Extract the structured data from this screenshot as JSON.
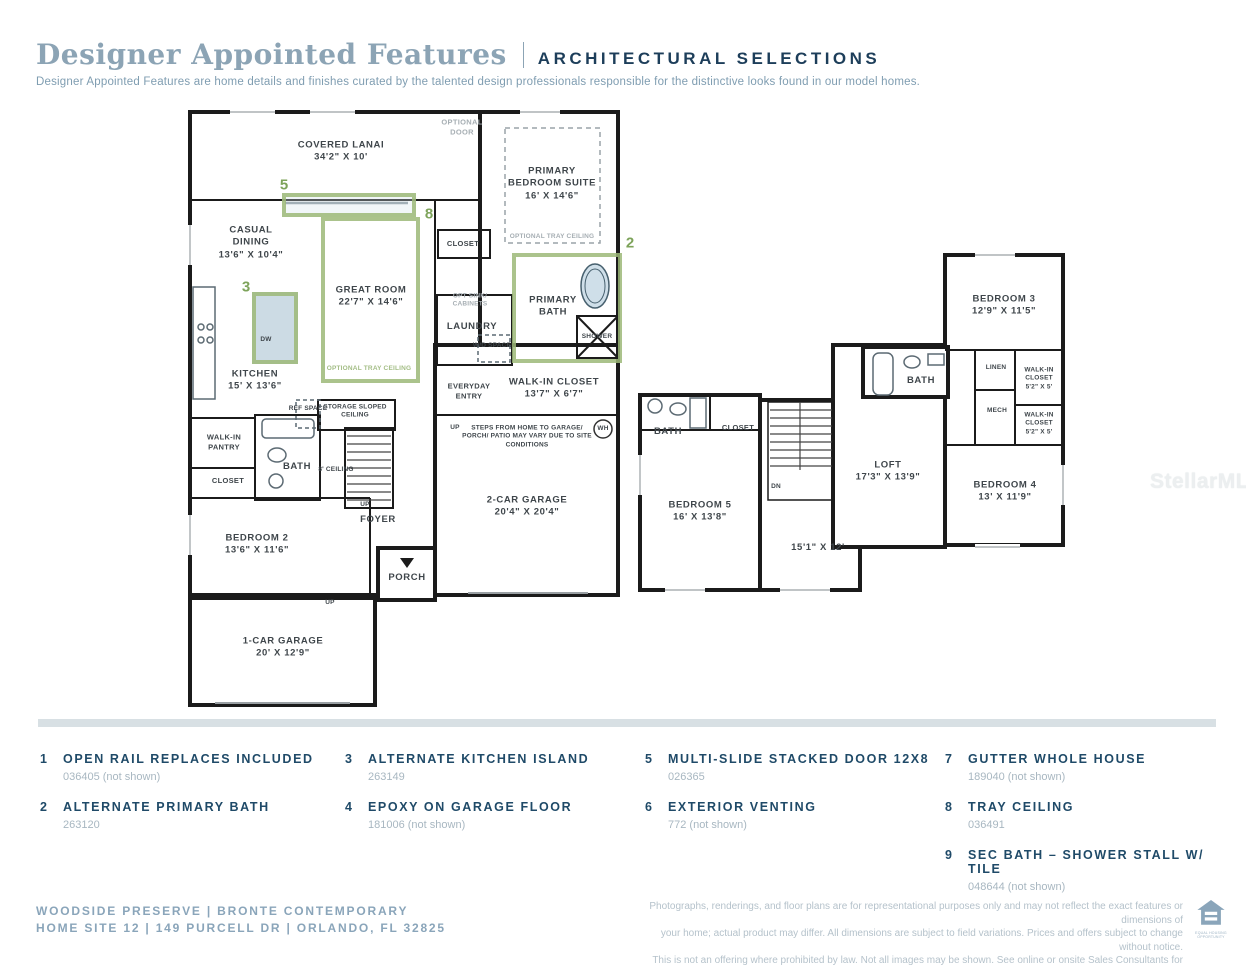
{
  "header": {
    "title": "Designer Appointed Features",
    "tag": "ARCHITECTURAL SELECTIONS",
    "subtitle": "Designer Appointed Features are home details and finishes curated by the talented design professionals responsible for the distinctive looks found in our model homes."
  },
  "watermark": "StellarMLS",
  "floor1": {
    "rooms": {
      "lanai": {
        "name": "COVERED LANAI",
        "dims": "34'2\" X 10'"
      },
      "suite": {
        "name": "PRIMARY BEDROOM SUITE",
        "dims": "16' X 14'6\""
      },
      "casual": {
        "name": "CASUAL DINING",
        "dims": "13'6\" X 10'4\""
      },
      "great": {
        "name": "GREAT ROOM",
        "dims": "22'7\" X 14'6\""
      },
      "kitchen": {
        "name": "KITCHEN",
        "dims": "15' X 13'6\""
      },
      "laundry": {
        "name": "LAUNDRY"
      },
      "pbath": {
        "name": "PRIMARY BATH"
      },
      "wic": {
        "name": "WALK-IN CLOSET",
        "dims": "13'7\" X 6'7\""
      },
      "garage2": {
        "name": "2-CAR GARAGE",
        "dims": "20'4\" X 20'4\""
      },
      "bed2": {
        "name": "BEDROOM 2",
        "dims": "13'6\" X 11'6\""
      },
      "foyer": {
        "name": "FOYER"
      },
      "porch": {
        "name": "PORCH"
      },
      "garage1": {
        "name": "1-CAR GARAGE",
        "dims": "20' X 12'9\""
      },
      "pantry": {
        "name": "WALK-IN PANTRY"
      },
      "bath": {
        "name": "BATH"
      },
      "closet_l": {
        "name": "CLOSET"
      },
      "closet_t": {
        "name": "CLOSET"
      },
      "storage": {
        "name": "STORAGE SLOPED CEILING"
      },
      "entry": {
        "name": "EVERYDAY ENTRY"
      }
    },
    "labels": {
      "optional_door": "OPTIONAL DOOR",
      "tray": "OPTIONAL TRAY CEILING",
      "opt_sink": "OPT SINK/ CABINETS",
      "wd": "W/D SPACE",
      "ref": "REF SPACE",
      "ceil8": "8' CEILING",
      "steps": "STEPS FROM HOME TO GARAGE/ PORCH/ PATIO MAY VARY DUE TO SITE CONDITIONS",
      "wh": "WH",
      "dw": "DW",
      "up": "UP",
      "shower": "SHOWER"
    },
    "annotations": {
      "door5": "5",
      "tray8": "8",
      "island3": "3",
      "bath2": "2"
    }
  },
  "floor2": {
    "rooms": {
      "bed3": {
        "name": "BEDROOM 3",
        "dims": "12'9\" X 11'5\""
      },
      "bath_r": {
        "name": "BATH"
      },
      "linen": {
        "name": "LINEN"
      },
      "wic1": {
        "name": "WALK-IN CLOSET",
        "dims": "5'2\" X 5'"
      },
      "mech": {
        "name": "MECH"
      },
      "wic2": {
        "name": "WALK-IN CLOSET",
        "dims": "5'2\" X 5'"
      },
      "bed4": {
        "name": "BEDROOM 4",
        "dims": "13' X 11'9\""
      },
      "loft": {
        "name": "LOFT",
        "dims": "17'3\" X 13'9\""
      },
      "bed5": {
        "name": "BEDROOM 5",
        "dims": "16' X 13'8\""
      },
      "bath_l": {
        "name": "BATH"
      },
      "closet": {
        "name": "CLOSET"
      },
      "open_dims": {
        "dims": "15'1\" X 12'"
      }
    },
    "labels": {
      "dn": "DN"
    }
  },
  "features": {
    "items": [
      {
        "num": "1",
        "title": "OPEN RAIL REPLACES INCLUDED",
        "code": "036405 (not shown)"
      },
      {
        "num": "2",
        "title": "ALTERNATE PRIMARY BATH",
        "code": "263120"
      },
      {
        "num": "3",
        "title": "ALTERNATE KITCHEN ISLAND",
        "code": "263149"
      },
      {
        "num": "4",
        "title": "EPOXY ON GARAGE FLOOR",
        "code": "181006 (not shown)"
      },
      {
        "num": "5",
        "title": "MULTI-SLIDE STACKED DOOR 12X8",
        "code": "026365"
      },
      {
        "num": "6",
        "title": "EXTERIOR VENTING",
        "code": "772 (not shown)"
      },
      {
        "num": "7",
        "title": "GUTTER WHOLE HOUSE",
        "code": "189040 (not shown)"
      },
      {
        "num": "8",
        "title": "TRAY CEILING",
        "code": "036491"
      },
      {
        "num": "9",
        "title": "SEC BATH – SHOWER STALL W/ TILE",
        "code": "048644 (not shown)"
      }
    ]
  },
  "footer": {
    "line1": "WOODSIDE PRESERVE | BRONTE CONTEMPORARY",
    "line2": "HOME SITE 12 | 149 PURCELL DR | ORLANDO, FL 32825",
    "disclaimer_lines": [
      "Photographs, renderings, and floor plans are for representational purposes only and may not reflect the exact features or dimensions of",
      "your home; actual product may differ. All dimensions are subject to field variations. Prices and offers subject to change without notice.",
      "This is not an offering where prohibited by law. Not all images may be shown. See online or onsite Sales Consultants for details."
    ],
    "logo_caption": "EQUAL HOUSING OPPORTUNITY"
  }
}
